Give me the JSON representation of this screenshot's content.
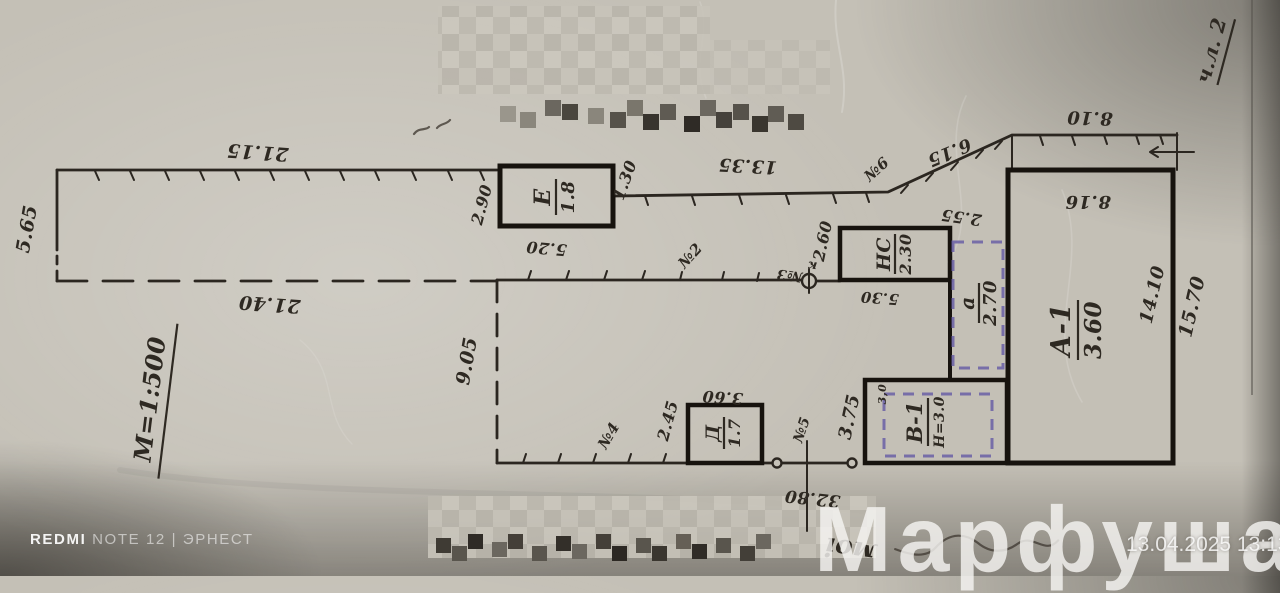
{
  "photo": {
    "camera_brand": "REDMI",
    "camera_model": "NOTE 12 | ЭРНЕСТ",
    "watermark": "Марфуша",
    "timestamp": "13.04.2025 13:13"
  },
  "plan": {
    "scale": "М=1:500",
    "sheet": "ч.л. 2",
    "buildings": {
      "a1": {
        "label": "А-1",
        "value": "3.60"
      },
      "e": {
        "label": "Е",
        "value": "1.8"
      },
      "ns": {
        "label": "НС",
        "value": "2.30"
      },
      "annex_a": {
        "label": "а",
        "value": "2.70"
      },
      "v1": {
        "label": "В-1",
        "height": "Н=3.0",
        "note": "3,0"
      },
      "d": {
        "label": "Д",
        "value": "1.7"
      }
    },
    "dims": {
      "strip_top": "21.15",
      "strip_left": "5.65",
      "strip_bottom": "21.40",
      "mid_top": "13.35",
      "diagonal": "6.15",
      "top_right": "8.10",
      "a1_top": "8.16",
      "a1_right_inner": "14.10",
      "right_outer": "15.70",
      "ns_left": "2.60",
      "ns_top_right": "2.55",
      "ns_bottom": "5.30",
      "e_left": "2.90",
      "e_bottom": "5.20",
      "e_right": "1.30",
      "d_left": "2.45",
      "d_top": "3.60",
      "v1_left": "3.75",
      "inner_left": "9.05",
      "ref_line": "32.80"
    },
    "points": {
      "n2": "№2",
      "n3": "№3",
      "n4": "№4",
      "n5": "№5",
      "n6": "№6",
      "k": "к"
    },
    "handwriting": {
      "fragment": "моі"
    }
  },
  "colors": {
    "ink": "#2b2620",
    "annex_dash": "#6a5fa6",
    "paper": "#c4c0b6",
    "watermark_text": "#f5f4f1"
  }
}
